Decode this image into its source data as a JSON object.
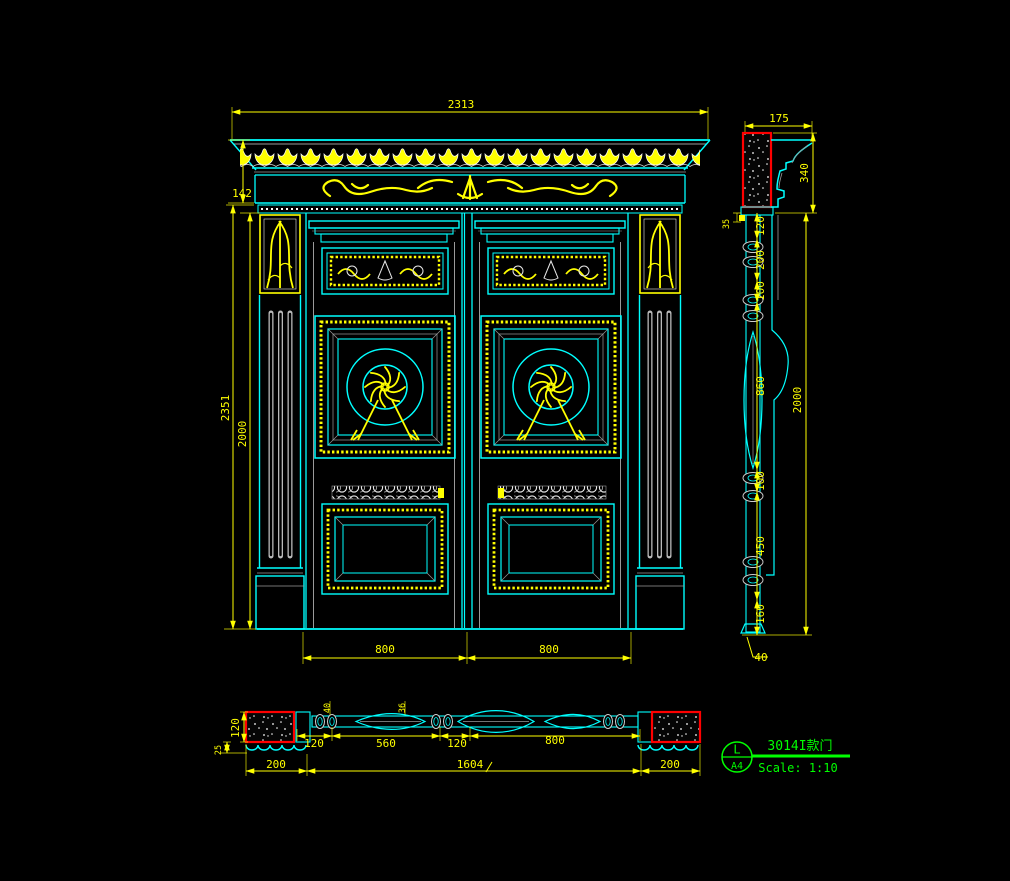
{
  "drawing": {
    "type_label": "door elevation / section CAD drawing",
    "background": "#000000"
  },
  "title_block": {
    "form_letter": "L",
    "paper_size": "A4",
    "product_name": "3014I款门",
    "scale_label": "Scale: 1:10"
  },
  "front_view": {
    "dims": {
      "overall_width": "2313",
      "frieze_height": "142",
      "overall_height": "2351",
      "door_height": "2000",
      "left_leaf_width": "800",
      "right_leaf_width": "800"
    }
  },
  "side_view": {
    "dims": {
      "cornice_depth": "175",
      "cornice_height": "340",
      "top_gap": "35",
      "seg_1": "120",
      "seg_2": "200",
      "seg_3": "100",
      "seg_4": "860",
      "seg_5": "100",
      "seg_6": "450",
      "seg_7": "160",
      "total_height": "2000",
      "bottom_thickness": "40"
    }
  },
  "plan_view": {
    "dims": {
      "frame_depth": "120",
      "sill_depth": "25",
      "wall_left": "200",
      "detail_top": "40",
      "detail_mid": "36",
      "jamb_width": "120",
      "panel_width": "560",
      "stile_width": "120",
      "leaf_width": "800",
      "frame_total": "1604",
      "wall_right": "200"
    }
  },
  "colors": {
    "line_cyan": "#00ffff",
    "dimension_yellow": "#ffff00",
    "wall_red": "#ff0000",
    "annotation_green": "#00ff00",
    "detail_white": "#e8e8e8",
    "hatch_gray": "#a8a8a8",
    "background": "#000000"
  }
}
